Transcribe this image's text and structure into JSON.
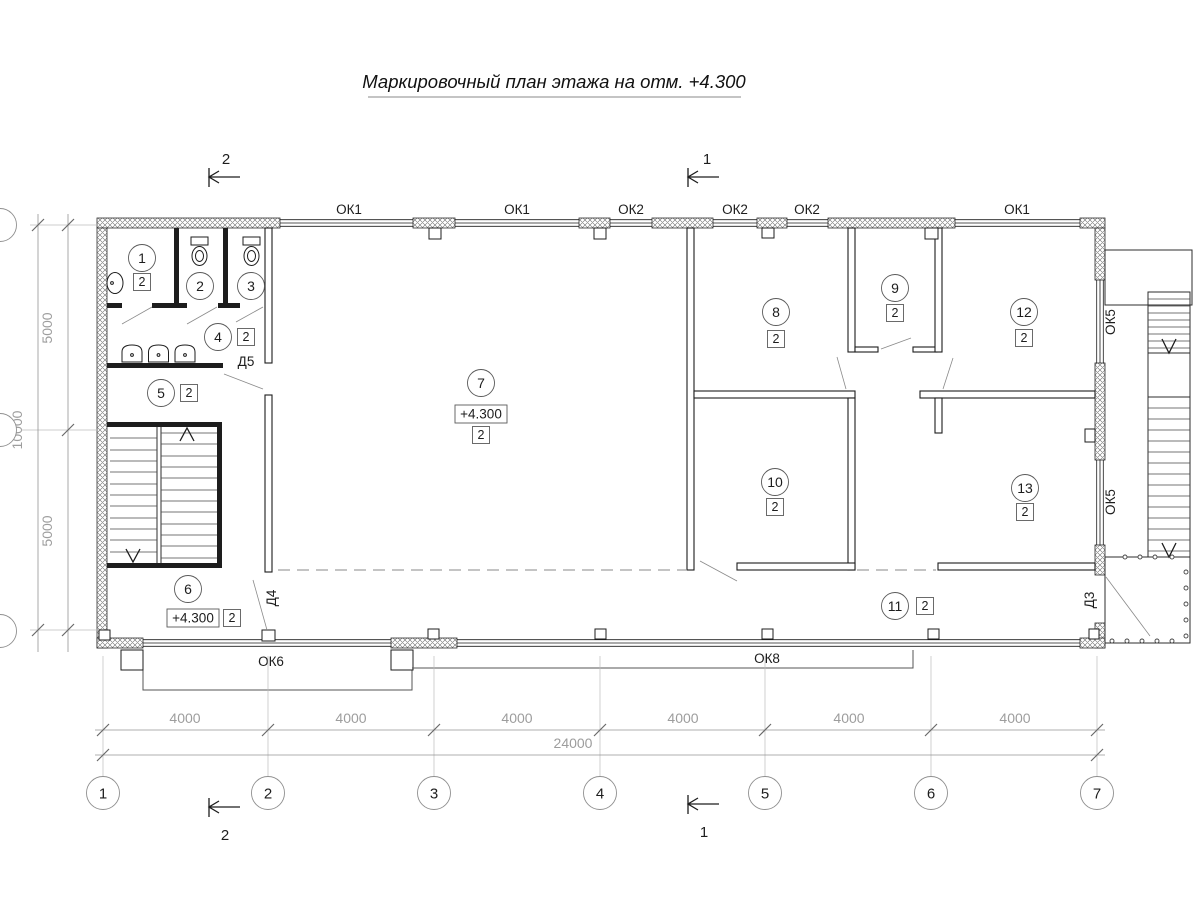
{
  "title": "Маркировочный план этажа на отм. +4.300",
  "colors": {
    "ink": "#1d1d1d",
    "dim_gray": "#9d9d9d",
    "background": "#ffffff"
  },
  "rooms": [
    {
      "num": "1",
      "type": "2"
    },
    {
      "num": "2"
    },
    {
      "num": "3"
    },
    {
      "num": "4",
      "type": "2"
    },
    {
      "num": "5",
      "type": "2"
    },
    {
      "num": "6",
      "type": "2",
      "elevation": "+4.300"
    },
    {
      "num": "7",
      "type": "2",
      "elevation": "+4.300"
    },
    {
      "num": "8",
      "type": "2"
    },
    {
      "num": "9",
      "type": "2"
    },
    {
      "num": "10",
      "type": "2"
    },
    {
      "num": "11",
      "type": "2"
    },
    {
      "num": "12",
      "type": "2"
    },
    {
      "num": "13",
      "type": "2"
    }
  ],
  "windows": {
    "ok1": "ОК1",
    "ok2": "ОК2",
    "ok5": "ОК5",
    "ok6": "ОК6",
    "ok8": "ОК8"
  },
  "doors": {
    "d3": "Д3",
    "d4": "Д4",
    "d5": "Д5"
  },
  "sections": {
    "s1": "1",
    "s2": "2"
  },
  "axes": [
    "1",
    "2",
    "3",
    "4",
    "5",
    "6",
    "7"
  ],
  "dims": {
    "bay": "4000",
    "total": "24000",
    "half": "5000",
    "depth": "10000"
  }
}
